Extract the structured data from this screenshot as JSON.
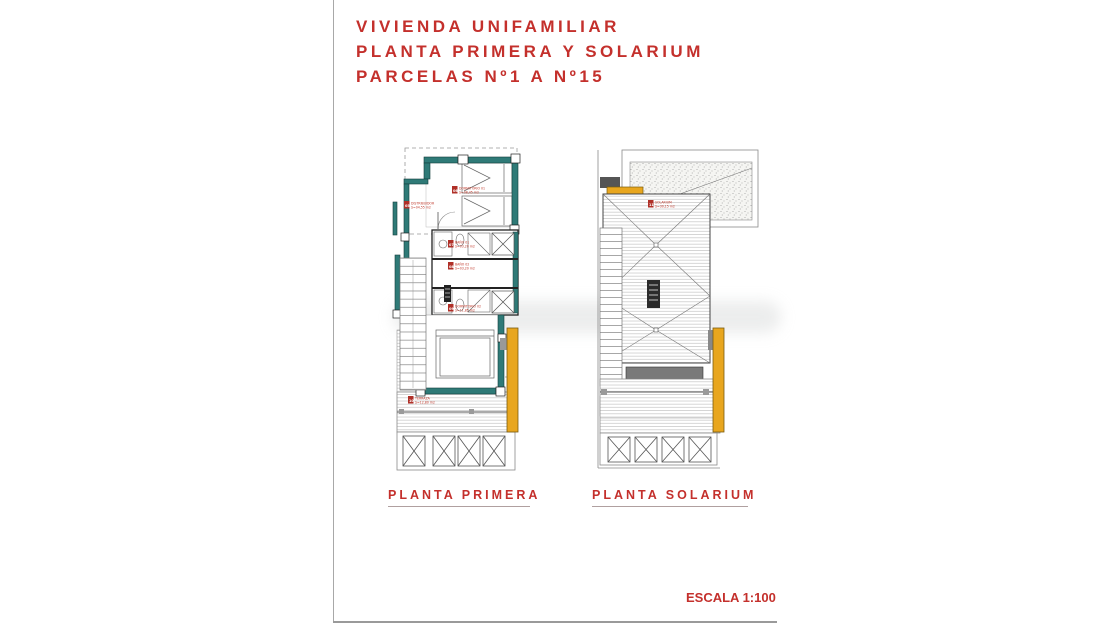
{
  "title": {
    "lines": [
      "VIVIENDA UNIFAMILIAR",
      "PLANTA PRIMERA Y SOLARIUM",
      "PARCELAS Nº1 A Nº15"
    ]
  },
  "plans": [
    {
      "caption": "PLANTA PRIMERA",
      "rooms": [
        {
          "num": "05",
          "name": "DISTRIBUIDOR",
          "area": "S=04,55 m2"
        },
        {
          "num": "06",
          "name": "DORMITORIO 01",
          "area": "S=08,45 m2"
        },
        {
          "num": "07",
          "name": "BAÑO 01",
          "area": "S=03,20 m2"
        },
        {
          "num": "08",
          "name": "BAÑO 02",
          "area": "S=03,20 m2"
        },
        {
          "num": "09",
          "name": "DORMITORIO 02",
          "area": "S=11,85 m2"
        },
        {
          "num": "10",
          "name": "TERRAZA",
          "area": "S=12,80 m2"
        }
      ]
    },
    {
      "caption": "PLANTA SOLARIUM",
      "rooms": [
        {
          "num": "11",
          "name": "SOLARIUM",
          "area": "S=30,15 m2"
        }
      ]
    }
  ],
  "scale": {
    "label": "ESCALA 1:100"
  },
  "colors": {
    "accent_red": "#c4302c",
    "wall_teal": "#2f7a77",
    "highlight_yellow": "#e8a61e",
    "beam_gray": "#7a7a7a"
  }
}
